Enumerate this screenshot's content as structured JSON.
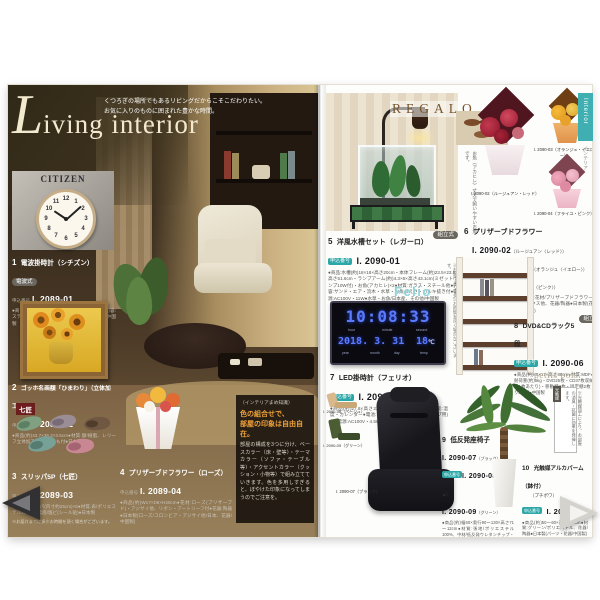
{
  "page": {
    "title_script": "L",
    "title_rest": "iving interior",
    "tagline1": "くつろぎの場所でもあるリビングだからこそこだわりたい。",
    "tagline2": "お気に入りのものに囲まれた豊かな時間。"
  },
  "colors": {
    "accent_teal": "#2ba7a7",
    "felio_logo": "#8ed4da",
    "regalo_logo": "#77552e",
    "led_blue": "#5b7bff",
    "title_cream": "#f2e9cf",
    "tips_heading_orange": "#f0a23a"
  },
  "left_page": {
    "citizen_logo": "CITIZEN",
    "clock_numerals": [
      "12",
      "1",
      "2",
      "3",
      "4",
      "5",
      "6",
      "7",
      "8",
      "9",
      "10",
      "11"
    ],
    "slipper_brand": "七匠",
    "tips": {
      "tag": "（インテリアまめ知識）",
      "heading1": "色の組合せで、",
      "heading2": "部屋の印象は自由自在。",
      "body": "部屋の構成を3つに分け、ベースカラー（床・壁等）・テーマカラー（ソファ・テーブル等）・アクセントカラー（クッション・小物等）で組み立てていきます。色を多用しすぎると、ぼやけた印象になってしまうのでご注意を。"
    },
    "items": [
      {
        "no": "1",
        "title": "電波掛時計（シチズン）",
        "badge": "電波式",
        "order_label": "申込番号",
        "code": "I. 2089-01",
        "desc": "●商品(約)φ31×4.6cm●材質:プラスチック枠●内容:ステップ秒針●電池:単3乾電池(お試し用)付●中国製"
      },
      {
        "no": "2",
        "title": "ゴッホ名画額「ひまわり」（立体加工付）",
        "order_label": "申込番号",
        "code": "I. 2089-02",
        "desc": "●商品(約)43.7×36.2×3.5cm●材質:額/樹脂、レリーフ立体加工●壁掛けひも付●日本製"
      },
      {
        "no": "3",
        "title": "スリッパ5P（七匠）",
        "order_label": "申込番号",
        "code": "I. 2089-03",
        "desc": "●商品:スリッパ(内寸約25cm)×5●材質:表/ポリエステル100%、裏底/塩ビ(シール貼)●日本製",
        "note": "※お届けまでに多少お時間を頂く場合がございます。"
      },
      {
        "no": "4",
        "title": "プリザーブドフラワー（ローズ）",
        "order_label": "申込番号",
        "code": "I. 2089-04",
        "desc": "●商品(約)W17×D8×H20cm●花材:ローズ(プリザーブド)・アジサイ他、リボン・アートリーフ付●花器:陶器●日本製(ローズ/コロンビア・アジサイ他/日本、花器/中国製)"
      }
    ]
  },
  "right_page": {
    "regalo_logo": "REGALO",
    "felio_logo": "Felio",
    "petits_pois": "petits pois.",
    "fish_caption": "お魚（アカヒレ）丈夫で飼いやすいお魚です。",
    "shelf_note": "※お届けまでに多少お時間を頂く場合がございます。",
    "plant_note_tag": "光触媒",
    "plant_note": "※光触媒加工により、お部屋の消臭・抗菌に効果を発揮します。",
    "flower_labels": {
      "red": "I. 2090-02（ルージュアン・レッド）",
      "yellow": "I. 2090-03（オランジュ・イエロー）",
      "pink": "I. 2090-04（フライユ・ピンク）"
    },
    "chair_labels": {
      "black": "I. 2090-07（ブラック）",
      "beige": "I. 2090-08（ベージュ）",
      "green": "I. 2090-09（グリーン）"
    },
    "led": {
      "time": "10:08:33",
      "labels_top": [
        "hour",
        "minute",
        "second"
      ],
      "date": "2018. 3. 31",
      "temp": "18",
      "temp_unit": "℃",
      "labels_bottom": [
        "year",
        "month",
        "day",
        "temp"
      ]
    },
    "items": [
      {
        "no": "5",
        "title": "洋風水槽セット（レガーロ）",
        "badge": "組立式",
        "order_label": "申込番号",
        "code": "I. 2090-01",
        "desc": "●商品:水槽(約)18×18×高さ20cm・本体フレーム(約)23.5×23.5×高さ51.6cm・ランプアーム(約)4.3×6×高さ43.1cm(ミゼットランプ10W付)・お魚(アカヒレ)×2●材質:ガラス・スチール他●内容:サンド・エア・流木・水草・お魚のえさ・カルキ抜き付●電源:AC100V・11W●水草・お魚/日本産、その他/中国製"
      },
      {
        "no": "6",
        "title": "プリザーブドフラワー",
        "order_label": "申込番号",
        "codes": [
          {
            "code": "I. 2090-02",
            "variant": "（ルージュアン〈レッド〉）"
          },
          {
            "code": "I. 2090-03",
            "variant": "（オランジュ〈イエロー〉）"
          },
          {
            "code": "I. 2090-04",
            "variant": "（フライユ〈ピンク〉）"
          }
        ],
        "desc": "●商品(約)24×21×高さ19cm●材質:花材/プリザーブドフラワー(ローズ・アジサイ他)・リボン・ボックス他、花器/陶器●日本製(花材/日本・エクアドル製他、花器/中国製)"
      },
      {
        "no": "7",
        "title": "LED掛時計（フェリオ）",
        "order_label": "申込番号",
        "code": "I. 2090-05",
        "desc": "●商品(約)27.6×高さ22.6×4cm●材質:スチール●機能:温度・カレンダー●電池:リチウム電池1個(バックアップ用)付●電源:AC100V・4.5W●中国製"
      },
      {
        "no": "8",
        "title": "DVD&CDラック5段",
        "badge": "組立式",
        "order_label": "申込番号",
        "code": "I. 2090-06",
        "desc": "●商品(約)45×17×高さ88cm●材質:MDF●内容:耐荷重(約)5kg・DVD25枚・CD37枚収納可(棚板1枚あたり)・移動棚3枚・固定棚2枚・仕切り3個付●中国製"
      },
      {
        "no": "9",
        "title": "低反発座椅子",
        "order_label": "申込番号",
        "codes": [
          {
            "code": "I. 2090-07",
            "variant": "（ブラック）"
          },
          {
            "code": "I. 2090-08",
            "variant": "（ベージュ）"
          },
          {
            "code": "I. 2090-09",
            "variant": "（グリーン）"
          }
        ],
        "desc": "●商品(約)幅60×奥行90～130×高さ71～12cm●材質:張地/ポリエステル100%、中材/低反発ウレタンチップ・ウレタンフォーム、フレーム/スチールパイプ●内容:背もたれ部/14段階リクライニング●日本製"
      },
      {
        "no": "10",
        "title": "光触媒アルカパーム（鉢付）",
        "title2": "（プチポワ）",
        "order_label": "申込番号",
        "code": "I. 2090-10",
        "desc": "●商品(約)50～60×高さ120cm●材質:グリーン/ポリエステル、花器/陶器●日本製(パーツ・花器/中国製)"
      }
    ]
  },
  "nav": {
    "side_tab": "Interior",
    "side_tab_sub": "インテリア"
  }
}
